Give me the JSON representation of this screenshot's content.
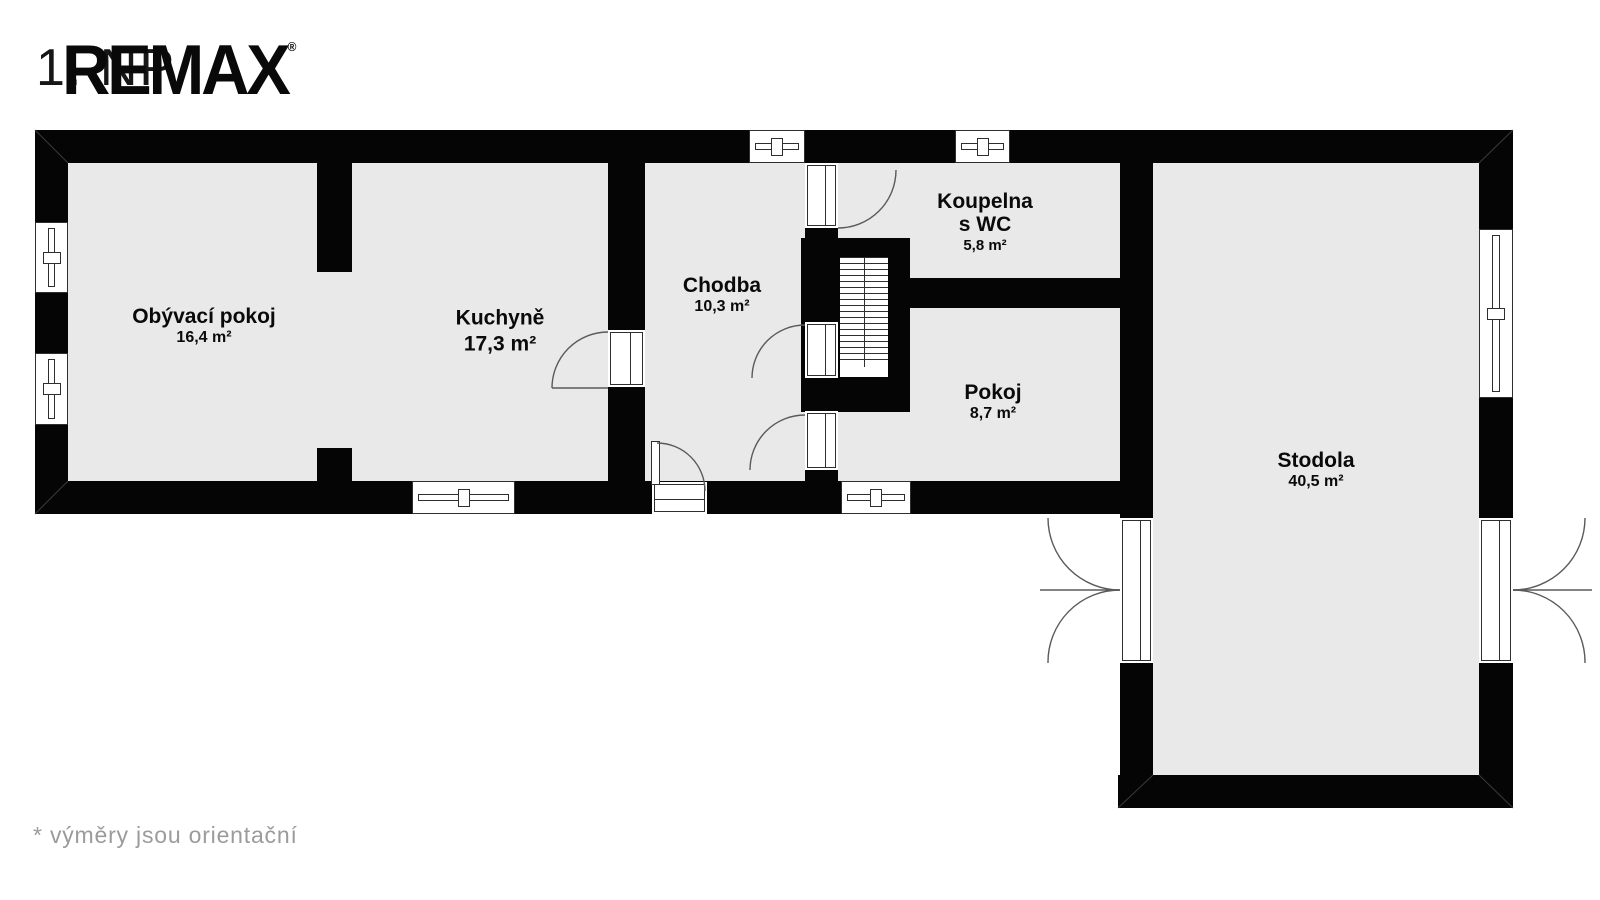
{
  "header": {
    "floor_label": "1. NP",
    "brand": "REMAX",
    "registered_mark": "®"
  },
  "rooms": [
    {
      "id": "obyvaci-pokoj",
      "name": "Obývací pokoj",
      "area": "16,4 m²"
    },
    {
      "id": "kuchyne",
      "name": "Kuchyně",
      "area": "17,3 m²"
    },
    {
      "id": "chodba",
      "name": "Chodba",
      "area": "10,3 m²"
    },
    {
      "id": "koupelna",
      "name": "Koupelna",
      "name2": "s WC",
      "area": "5,8 m²"
    },
    {
      "id": "pokoj",
      "name": "Pokoj",
      "area": "8,7 m²"
    },
    {
      "id": "stodola",
      "name": "Stodola",
      "area": "40,5 m²"
    }
  ],
  "footnote": "*  výměry jsou orientační",
  "colors": {
    "wall": "#050505",
    "room_fill": "#e9e9e9",
    "frame_line": "#2e2e2e",
    "swing_arc": "#5a5a5a",
    "footnote_text": "#9b9b9b",
    "brand_text": "#090909"
  }
}
